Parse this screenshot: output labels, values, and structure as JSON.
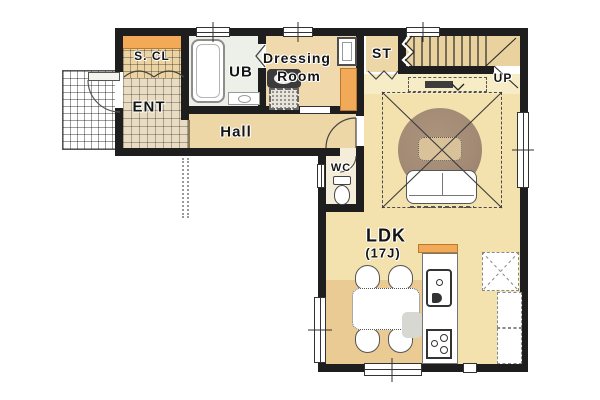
{
  "meta": {
    "type": "floor-plan",
    "style": "japanese-residential-1f"
  },
  "rooms": {
    "shoe_closet": {
      "label": "S. CL"
    },
    "unit_bath": {
      "label": "UB"
    },
    "dressing_room": {
      "label_line1": "Dressing",
      "label_line2": "Room"
    },
    "storage": {
      "label": "ST"
    },
    "entrance": {
      "label": "ENT"
    },
    "hall": {
      "label": "Hall"
    },
    "toilet_room": {
      "label": "WC"
    },
    "ldk": {
      "label": "LDK",
      "size": "(17J)"
    }
  },
  "stairs": {
    "direction_label": "UP"
  },
  "colors": {
    "wall": "#1e1e1e",
    "wood_floor": "#f2dfa9",
    "wood_floor_dining": "#e9cb93",
    "tv_strip": "#f6ecc6",
    "entrance_tile": "#e9dcc2",
    "scl_tile": "#ecd3a2",
    "accent_orange": "#f2a958",
    "unit_bath_floor": "#edefe9",
    "wc_floor": "#f3edda",
    "rug": "#9c8370",
    "background": "#ffffff"
  },
  "fixtures": [
    "bathtub",
    "ub-counter-sink",
    "washbasin",
    "washing-machine",
    "shower-cabinet",
    "tall-cabinet",
    "toilet",
    "staircase",
    "tv-board",
    "round-rug",
    "coffee-table",
    "sofa",
    "dining-table",
    "dining-chairs",
    "kitchen-island",
    "kitchen-sink",
    "gas-stove",
    "refrigerator-space",
    "pantry-shelves",
    "entrance-door",
    "closet-folding-doors",
    "porch"
  ]
}
